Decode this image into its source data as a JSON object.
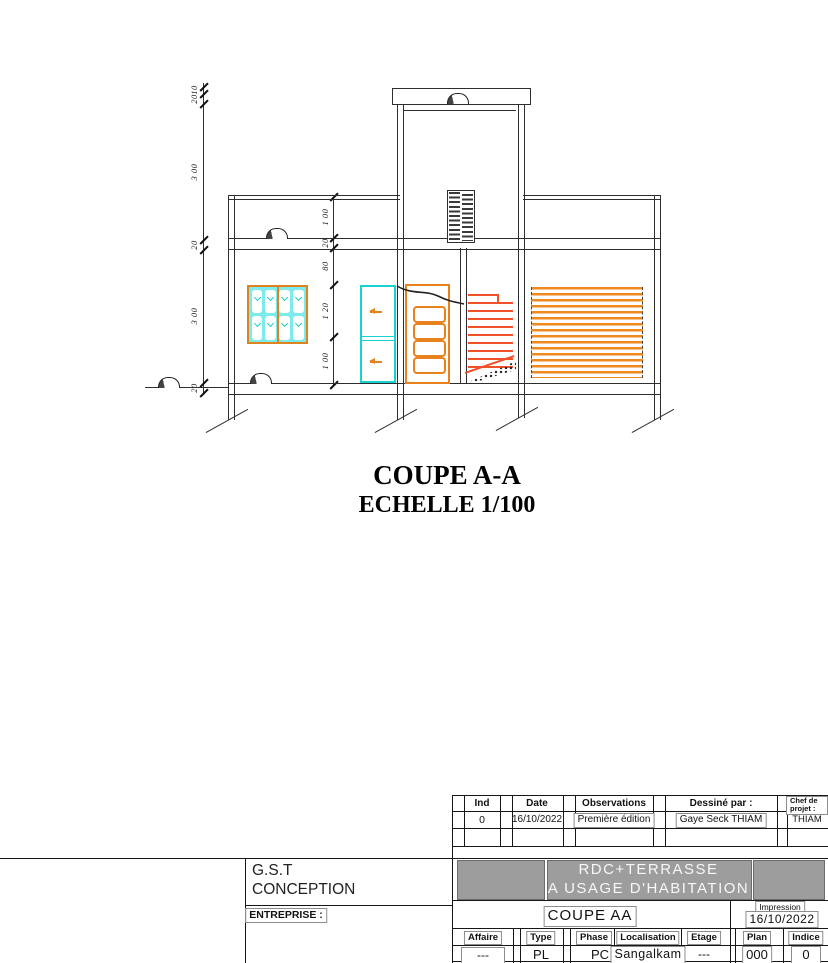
{
  "drawing": {
    "title": "COUPE A-A",
    "subtitle": "ECHELLE 1/100",
    "left_dims": [
      "10",
      "20",
      "3 00",
      "20",
      "3 00",
      "20"
    ],
    "mid_dims": [
      "1 00",
      "20",
      "80",
      "1 20",
      "1 00"
    ],
    "colors": {
      "line": "#2e2e2e",
      "orange": "#e8821c",
      "stair": "#f0512a",
      "cyan": "#17c9c9",
      "window_fill": "#7debeb"
    }
  },
  "titleblock": {
    "revisions": {
      "headers": {
        "ind": "Ind",
        "date": "Date",
        "observations": "Observations",
        "dessine": "Dessiné par :",
        "chef": "Chef de projet :"
      },
      "row": {
        "ind": "0",
        "date": "16/10/2022",
        "observations": "Première édition",
        "dessine": "Gaye Seck THIAM",
        "chef": "THIAM"
      }
    },
    "company_line1": "G.S.T",
    "company_line2": "CONCEPTION",
    "entreprise_label": "ENTREPRISE :",
    "project_line1": "RDC+TERRASSE",
    "project_line2": "A USAGE D'HABITATION",
    "drawing_name": "COUPE AA",
    "impression_label": "Impression",
    "impression_date": "16/10/2022",
    "fields": {
      "affaire_label": "Affaire",
      "affaire_value": "---",
      "type_label": "Type",
      "type_value": "PL",
      "phase_label": "Phase",
      "phase_value": "PC",
      "localisation_label": "Localisation",
      "localisation_value": "Sangalkam",
      "etage_label": "Etage",
      "etage_value": "---",
      "plan_label": "Plan",
      "plan_value": "000",
      "indice_label": "Indice",
      "indice_value": "0"
    }
  }
}
